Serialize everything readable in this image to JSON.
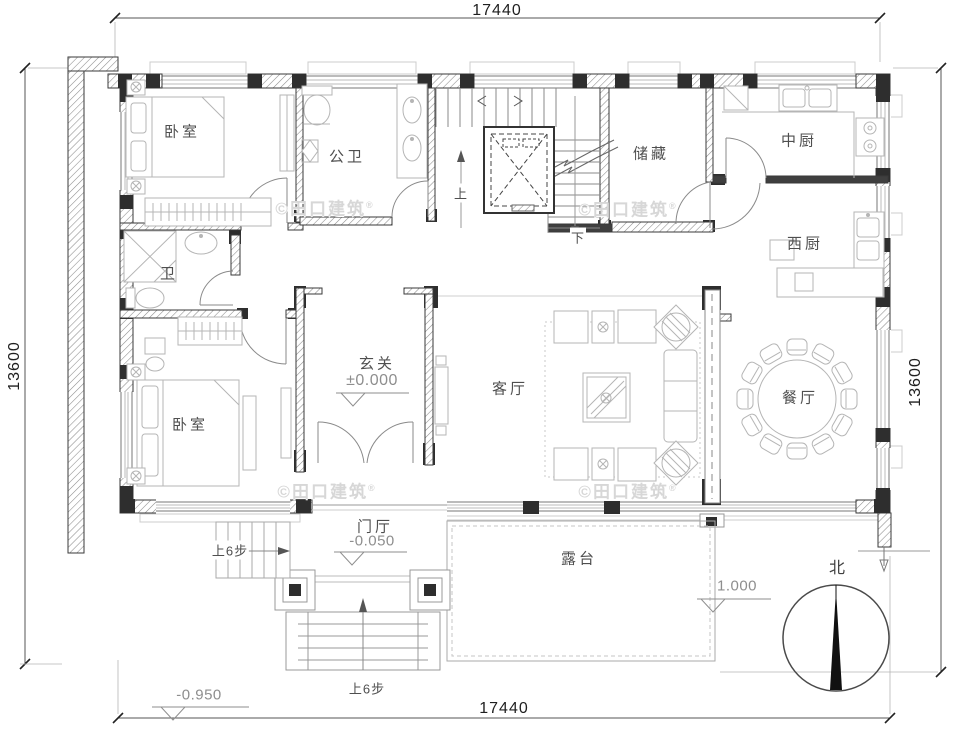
{
  "title": "二层平面图 floor plan",
  "dimensions": {
    "top": "17440",
    "bottom": "17440",
    "left": "13600",
    "right": "13600"
  },
  "rooms": {
    "bedroom_top": "卧室",
    "bedroom_bottom": "卧室",
    "public_bath": "公卫",
    "bath": "卫",
    "storage": "储藏",
    "chinese_kitchen": "中厨",
    "western_kitchen": "西厨",
    "entry_hall": "玄关",
    "living_room": "客厅",
    "dining_room": "餐厅",
    "foyer": "门厅",
    "terrace": "露台"
  },
  "levels": {
    "entry_hall": "±0.000",
    "foyer": "-0.050",
    "site": "-0.950",
    "terrace": "1.000"
  },
  "stairs": {
    "up": "上",
    "down": "下",
    "side_steps": "上6步",
    "main_steps": "上6步"
  },
  "compass": {
    "north_label": "北"
  },
  "watermark": {
    "text": "©田口建筑",
    "registered": "®"
  },
  "colors": {
    "wall_dark": "#2e2e2e",
    "wall_line": "#3a3a3a",
    "hatch": "#8c8c8c",
    "furniture": "#b5b5b5",
    "dimension_text": "#1f1f1f",
    "room_label": "#4f4f4f",
    "level_text": "#8e8e8e",
    "watermark": "#d7d7d7",
    "background": "#ffffff"
  }
}
